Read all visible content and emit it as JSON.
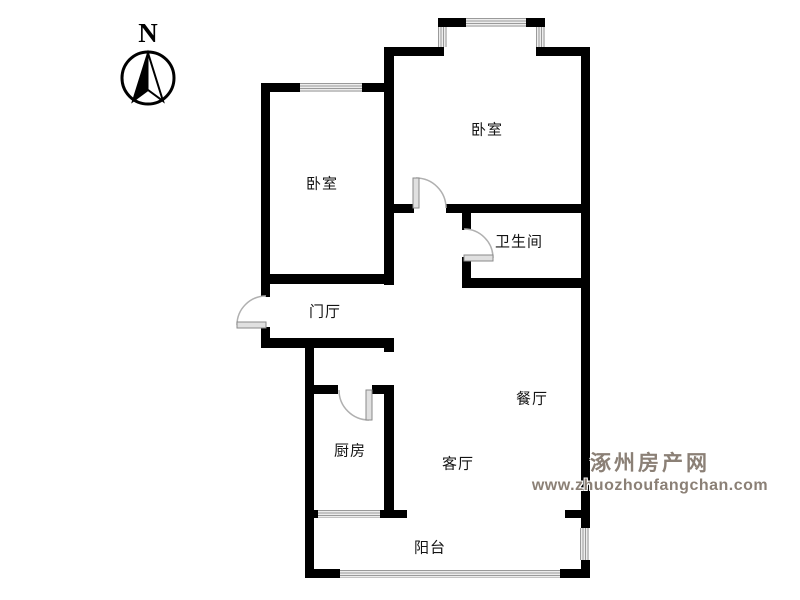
{
  "compass": {
    "label": "N"
  },
  "rooms": {
    "bedroom_top": {
      "label": "卧室"
    },
    "bedroom_left": {
      "label": "卧室"
    },
    "bathroom": {
      "label": "卫生间"
    },
    "entry_hall": {
      "label": "门厅"
    },
    "kitchen": {
      "label": "厨房"
    },
    "dining": {
      "label": "餐厅"
    },
    "living": {
      "label": "客厅"
    },
    "balcony": {
      "label": "阳台"
    }
  },
  "watermark": {
    "site_name": "涿州房产网",
    "site_url": "www.zhuozhoufangchan.com",
    "color": "#8b8076"
  },
  "colors": {
    "wall": "#000000",
    "window_hatch": "#9a9a9a",
    "door_leaf": "#e0e0e0",
    "door_arc": "#b0b0b0",
    "label_text": "#141414"
  }
}
